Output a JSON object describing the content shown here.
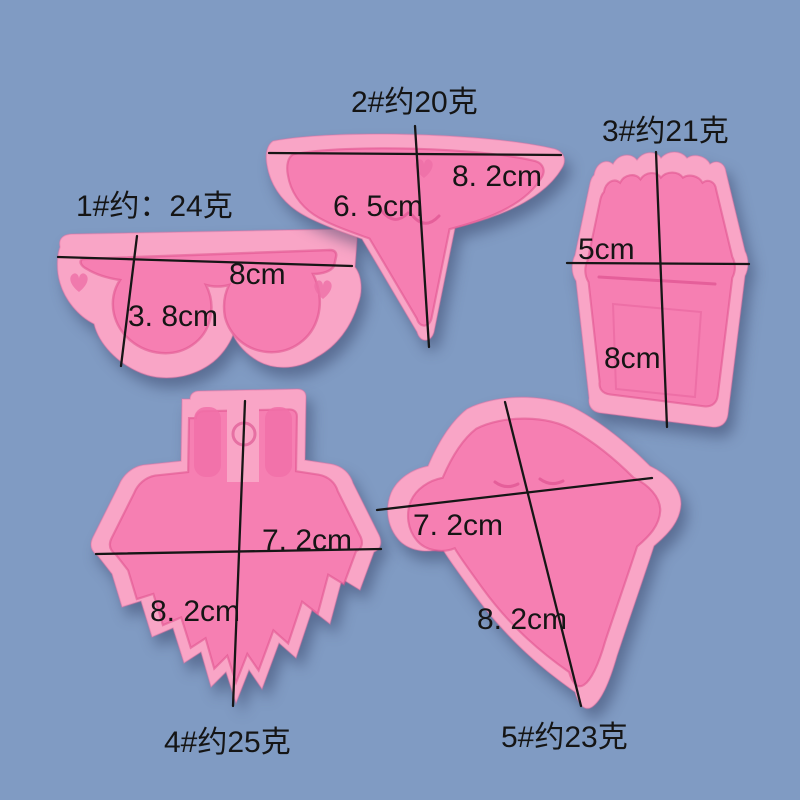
{
  "colors": {
    "background": "#809bc3",
    "mold_pink": "#f9a5c6",
    "cavity_pink": "#f67fb2",
    "annotation": "#161616"
  },
  "molds": [
    {
      "shape": "sunglasses",
      "label": "1#约：24克",
      "measurements": [
        "8cm",
        "3. 8cm"
      ]
    },
    {
      "shape": "ice-cream-cone",
      "label": "2#约20克",
      "measurements": [
        "8. 2cm",
        "6. 5cm"
      ]
    },
    {
      "shape": "milkshake-cup",
      "label": "3#约21克",
      "measurements": [
        "5cm",
        "8cm"
      ]
    },
    {
      "shape": "dress-skirt",
      "label": "4#约25克",
      "measurements": [
        "7. 2cm",
        "8. 2cm"
      ]
    },
    {
      "shape": "ghost",
      "label": "5#约23克",
      "measurements": [
        "7. 2cm",
        "8. 2cm"
      ]
    }
  ]
}
